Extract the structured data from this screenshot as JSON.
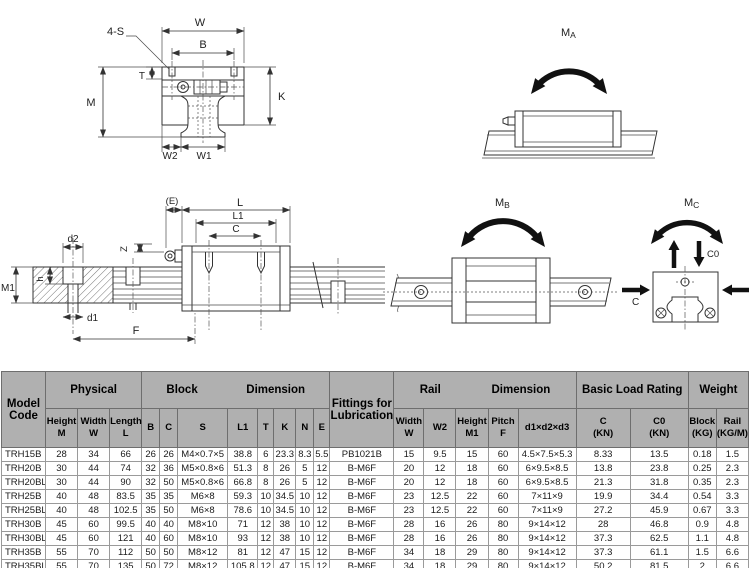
{
  "diagram": {
    "front_view": {
      "s4": "4-S",
      "w": "W",
      "b": "B",
      "t": "T",
      "m": "M",
      "k": "K",
      "w2": "W2",
      "w1": "W1"
    },
    "side_view": {
      "e": "(E)",
      "l": "L",
      "l1": "L1",
      "c": "C",
      "z": "Z",
      "d2": "d2",
      "h": "h",
      "m1": "M1",
      "d1": "d1",
      "f": "F"
    },
    "moments": {
      "ma_main": "M",
      "ma_sub": "A",
      "mb_main": "M",
      "mb_sub": "B",
      "mc_main": "M",
      "mc_sub": "C",
      "c_label": "C",
      "c0_label": "C0"
    }
  },
  "table": {
    "group_header": {
      "model_code": "Model\nCode",
      "physical": "Physical",
      "block": "Block",
      "block_dimension": "Dimension",
      "lubrication": "Fittings for\nLubrication",
      "rail": "Rail",
      "rail_dimension": "Dimension",
      "basic_load_rating": "Basic Load Rating",
      "weight": "Weight"
    },
    "sub_header": [
      "Height\nM",
      "Width\nW",
      "Length\nL",
      "B",
      "C",
      "S",
      "L1",
      "T",
      "K",
      "N",
      "E",
      "Width\nW",
      "W2",
      "Height\nM1",
      "Pitch\nF",
      "d1×d2×d3",
      "C\n(KN)",
      "C0\n(KN)",
      "Block\n(KG)",
      "Rail\n(KG/M)"
    ],
    "rows": [
      [
        "TRH15B",
        "28",
        "34",
        "66",
        "26",
        "26",
        "M4×0.7×5",
        "38.8",
        "6",
        "23.3",
        "8.3",
        "5.5",
        "PB1021B",
        "15",
        "9.5",
        "15",
        "60",
        "4.5×7.5×5.3",
        "8.33",
        "13.5",
        "0.18",
        "1.5"
      ],
      [
        "TRH20B",
        "30",
        "44",
        "74",
        "32",
        "36",
        "M5×0.8×6",
        "51.3",
        "8",
        "26",
        "5",
        "12",
        "B-M6F",
        "20",
        "12",
        "18",
        "60",
        "6×9.5×8.5",
        "13.8",
        "23.8",
        "0.25",
        "2.3"
      ],
      [
        "TRH20BL",
        "30",
        "44",
        "90",
        "32",
        "50",
        "M5×0.8×6",
        "66.8",
        "8",
        "26",
        "5",
        "12",
        "B-M6F",
        "20",
        "12",
        "18",
        "60",
        "6×9.5×8.5",
        "21.3",
        "31.8",
        "0.35",
        "2.3"
      ],
      [
        "TRH25B",
        "40",
        "48",
        "83.5",
        "35",
        "35",
        "M6×8",
        "59.3",
        "10",
        "34.5",
        "10",
        "12",
        "B-M6F",
        "23",
        "12.5",
        "22",
        "60",
        "7×11×9",
        "19.9",
        "34.4",
        "0.54",
        "3.3"
      ],
      [
        "TRH25BL",
        "40",
        "48",
        "102.5",
        "35",
        "50",
        "M6×8",
        "78.6",
        "10",
        "34.5",
        "10",
        "12",
        "B-M6F",
        "23",
        "12.5",
        "22",
        "60",
        "7×11×9",
        "27.2",
        "45.9",
        "0.67",
        "3.3"
      ],
      [
        "TRH30B",
        "45",
        "60",
        "99.5",
        "40",
        "40",
        "M8×10",
        "71",
        "12",
        "38",
        "10",
        "12",
        "B-M6F",
        "28",
        "16",
        "26",
        "80",
        "9×14×12",
        "28",
        "46.8",
        "0.9",
        "4.8"
      ],
      [
        "TRH30BL",
        "45",
        "60",
        "121",
        "40",
        "60",
        "M8×10",
        "93",
        "12",
        "38",
        "10",
        "12",
        "B-M6F",
        "28",
        "16",
        "26",
        "80",
        "9×14×12",
        "37.3",
        "62.5",
        "1.1",
        "4.8"
      ],
      [
        "TRH35B",
        "55",
        "70",
        "112",
        "50",
        "50",
        "M8×12",
        "81",
        "12",
        "47",
        "15",
        "12",
        "B-M6F",
        "34",
        "18",
        "29",
        "80",
        "9×14×12",
        "37.3",
        "61.1",
        "1.5",
        "6.6"
      ],
      [
        "TRH35BL",
        "55",
        "70",
        "135",
        "50",
        "72",
        "M8×12",
        "105.8",
        "12",
        "47",
        "15",
        "12",
        "B-M6F",
        "34",
        "18",
        "29",
        "80",
        "9×14×12",
        "50.2",
        "81.5",
        "2",
        "6.6"
      ],
      [
        "TRH45B",
        "70",
        "86",
        "139",
        "60",
        "60",
        "M10×17",
        "98",
        "15",
        "60",
        "20",
        "16",
        "B-PT1/8",
        "45",
        "20.5",
        "38",
        "105",
        "14×20×17",
        "60",
        "95.6",
        "2.6",
        "11"
      ]
    ]
  }
}
